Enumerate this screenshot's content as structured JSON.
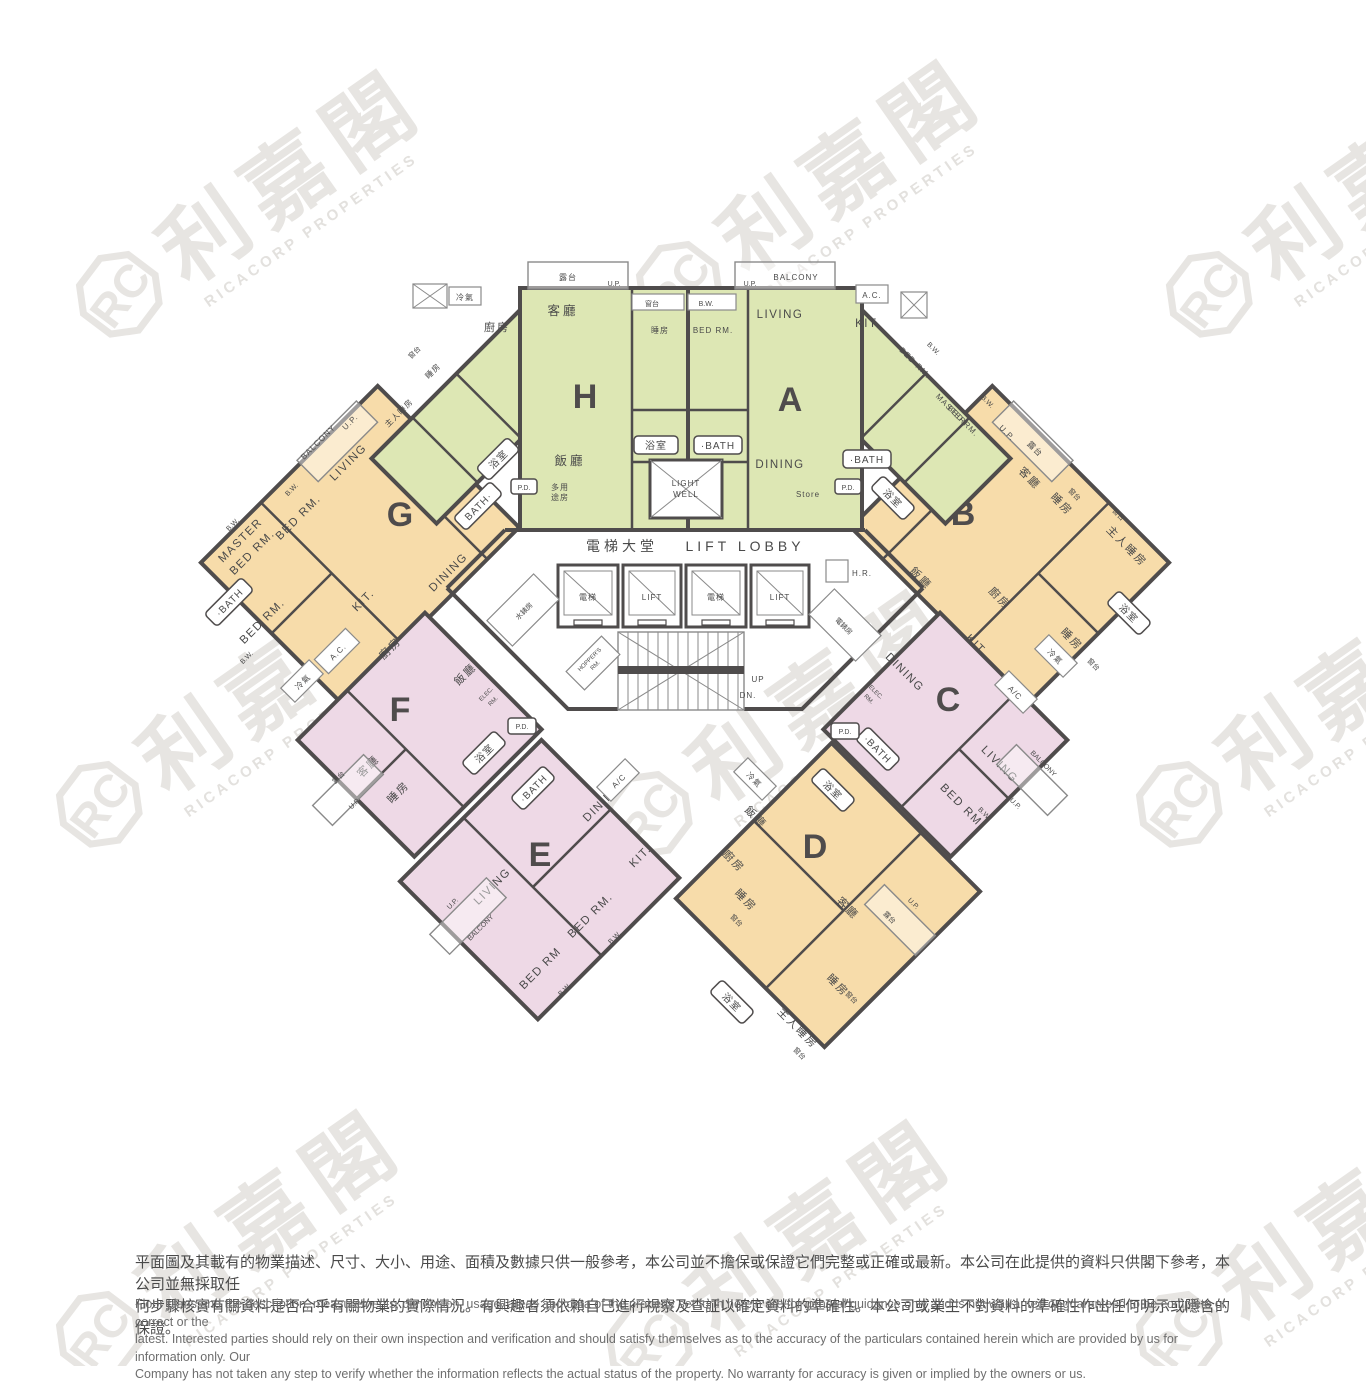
{
  "watermark": {
    "monogram": "RC",
    "cjk": "利嘉閣",
    "en": "RICACORP PROPERTIES"
  },
  "colors": {
    "green": "#dde7b4",
    "orange": "#f7dcaa",
    "pink": "#eed9e6",
    "wall": "#4f4c4c",
    "watermark": "#e7e5e2"
  },
  "lobby": {
    "hall_cjk": "電梯大堂",
    "hall_en": "LIFT LOBBY",
    "lift_cjk": "電梯",
    "lift_en": "LIFT",
    "water_meter": "水錶房",
    "elec_meter": "電錶房",
    "hr": "H.R.",
    "hopper_1": "HOPPER'S",
    "hopper_2": "RM.",
    "up": "UP",
    "dn": "DN.",
    "light_well_1": "LIGHT",
    "light_well_2": "WELL"
  },
  "common": {
    "up": "U.P.",
    "bw": "B.W.",
    "pd": "P.D.",
    "ac": "A.C.",
    "ac2": "A/C",
    "cold": "冷氣",
    "bay": "窗台",
    "balcony_en": "BALCONY",
    "balcony_cjk": "露台",
    "store": "Store",
    "elec_rm_1": "ELEC.",
    "elec_rm_2": "RM."
  },
  "units": {
    "h": {
      "letter": "H",
      "living": "客廳",
      "dining": "飯廳",
      "bed": "睡房",
      "kitchen": "廚房",
      "master": "主人睡房",
      "bath": "浴室",
      "multi_1": "多用",
      "multi_2": "途房"
    },
    "a": {
      "letter": "A",
      "living": "LIVING",
      "dining": "DINING",
      "bed": "BED RM.",
      "kitchen": "KIT.",
      "master_1": "MASTER",
      "master_2": "BED RM.",
      "bath": "·BATH"
    },
    "g": {
      "letter": "G",
      "living": "LIVING",
      "dining": "DINING",
      "bed": "BED RM.",
      "kitchen": "KIT.",
      "master_1": "MASTER",
      "master_2": "BED RM.",
      "bath": "BATH·",
      "bath2": "·BATH"
    },
    "b": {
      "letter": "B",
      "living": "客廳",
      "dining": "飯廳",
      "bed": "睡房",
      "kitchen": "廚房",
      "master": "主人睡房",
      "bath": "浴室"
    },
    "f": {
      "letter": "F",
      "living": "客廳",
      "dining": "飯廳",
      "bed": "睡房",
      "kitchen": "廚房",
      "bath": "浴室"
    },
    "c": {
      "letter": "C",
      "living": "LIVING",
      "dining": "DINING",
      "bed": "BED RM.",
      "bed2": "BED RM",
      "kitchen": "KIT.",
      "bath": "·BATH"
    },
    "e": {
      "letter": "E",
      "living": "LIVING",
      "dining": "DINING",
      "bed": "BED RM.",
      "bed2": "BED RM",
      "kitchen": "KIT.",
      "bath": "·BATH"
    },
    "d": {
      "letter": "D",
      "living": "客廳",
      "dining": "飯廳",
      "bed": "睡房",
      "kitchen": "廚房",
      "master": "主人睡房",
      "bath": "浴室"
    }
  },
  "disclaimer": {
    "zh1": "平面圖及其載有的物業描述、尺寸、大小、用途、面積及數據只供一般參考，本公司並不擔保或保證它們完整或正確或最新。本公司在此提供的資料只供閣下參考，本公司並無採取任",
    "zh2": "何步驟核實有關資料是否合乎有關物業的實際情況。有興趣者須依賴自己進行視察及查証以確定資料的準確性。本公司或業主不對資料的準確性作出任何明示或隱含的保證。",
    "en1": "Floor plans and the description, measurements, dimension, usage, areas and data of the property set forth herein are for general guidance only and Is not warranted or guaranteed to be complete or correct or the",
    "en2": "latest. Interested parties should rely on their own inspection and verification and should satisfy themselves as to the accuracy of the particulars contained herein which are provided by us for information only.  Our",
    "en3": "Company has not taken any step to verify whether the information reflects the actual status of the property.  No warranty for accuracy is given or implied by the owners or us."
  }
}
